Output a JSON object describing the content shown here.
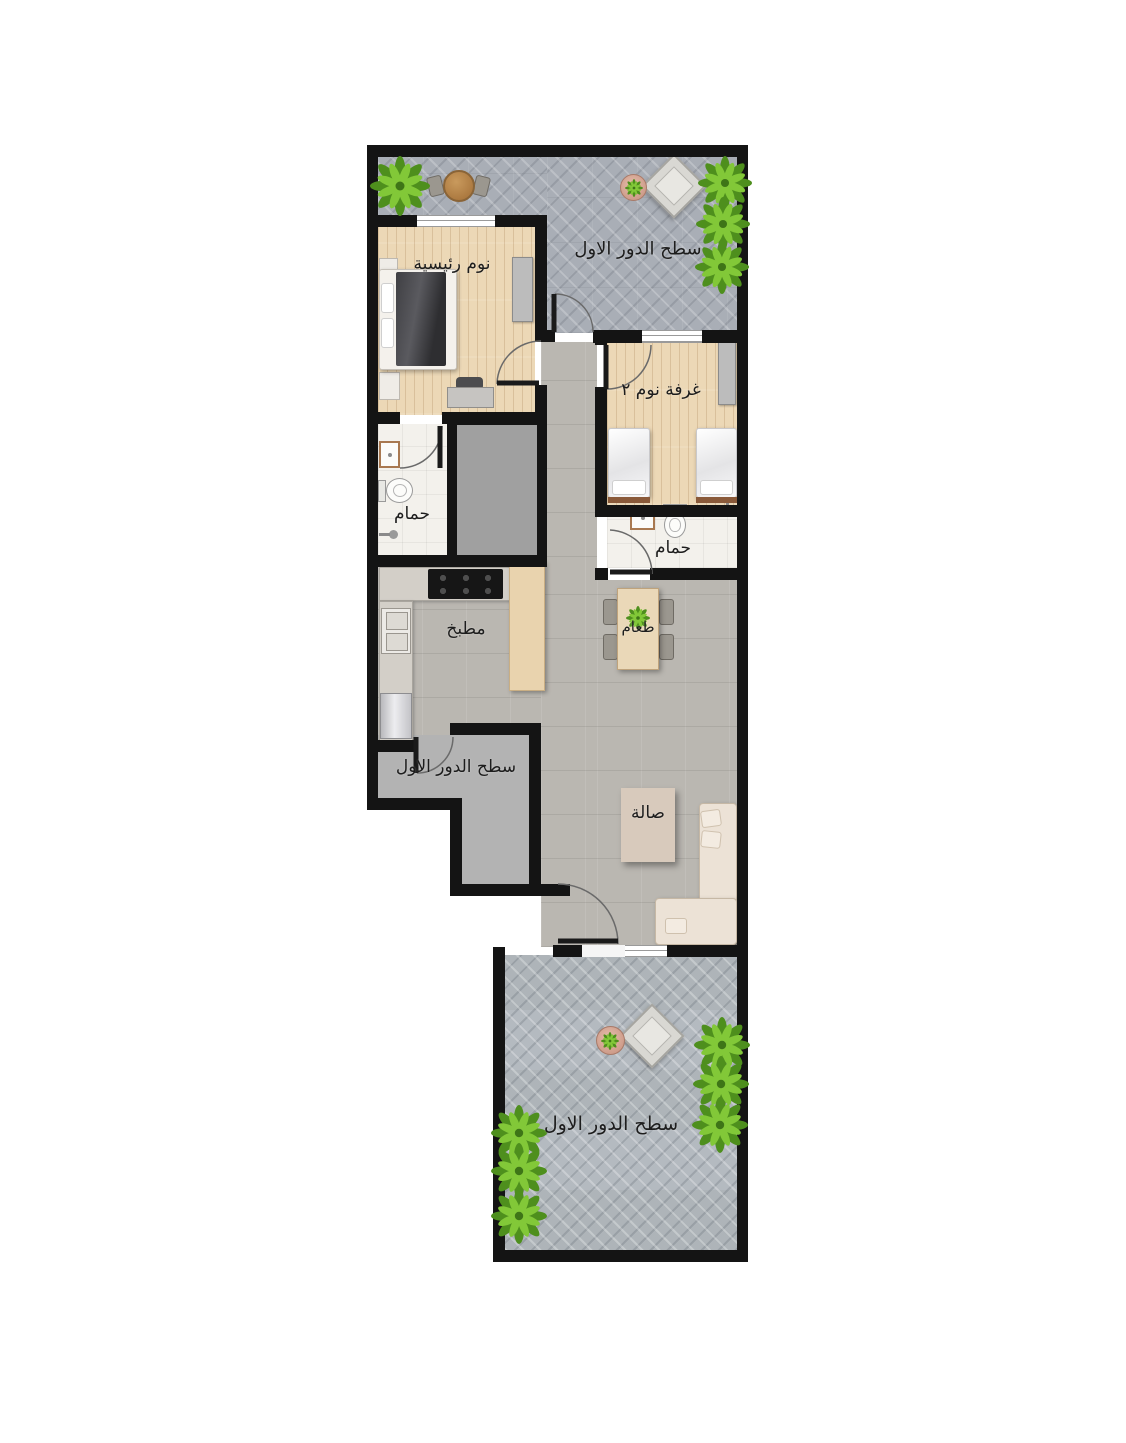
{
  "plan_title": "apartment-first-floor-plan",
  "rooms": {
    "terrace_top": {
      "label": "سطح الدور الاول"
    },
    "master_bedroom": {
      "label": "نوم رئيسية"
    },
    "bedroom_2": {
      "label": "غرفة نوم ٢"
    },
    "bathroom_1": {
      "label": "حمام"
    },
    "bathroom_2": {
      "label": "حمام"
    },
    "kitchen": {
      "label": "مطبخ"
    },
    "dining": {
      "label": "طعام"
    },
    "terrace_side": {
      "label": "سطح الدور الاول"
    },
    "living": {
      "label": "صالة"
    },
    "terrace_bottom": {
      "label": "سطح الدور الاول"
    }
  },
  "colors": {
    "wall": "#141414",
    "wood_floor": "#ecd8b6",
    "tile_floor": "#bab7b1",
    "paver_floor": "#a9aeb6",
    "bath_floor": "#f3f1ec",
    "side_terrace_floor": "#b3b3b3",
    "kitchen_island": "#e9d3ae",
    "sofa": "#ece2d6",
    "plant_green": "#64a82a",
    "dark_blanket": "#47474b"
  }
}
